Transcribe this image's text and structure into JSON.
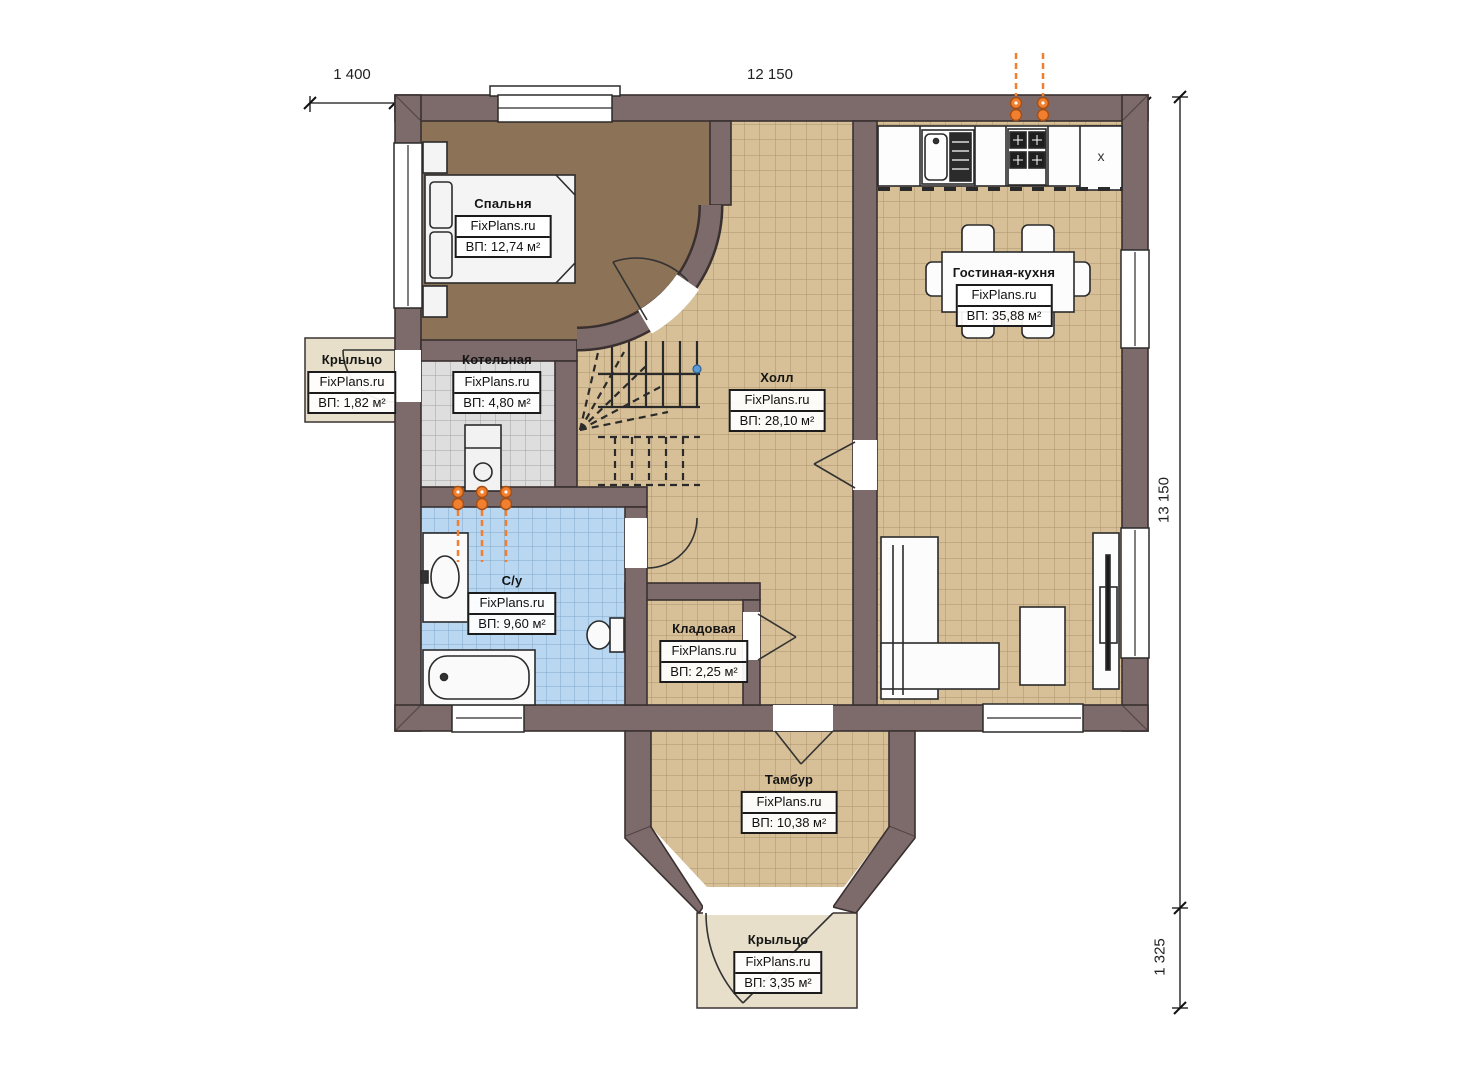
{
  "plan": {
    "watermark": "FixPlans.ru",
    "dimensions": {
      "top_left": "1 400",
      "top_width": "12 150",
      "right_height": "13 150",
      "right_porch": "1 325"
    },
    "rooms": [
      {
        "name": "Спальня",
        "area": "ВП: 12,74 м²"
      },
      {
        "name": "Котельная",
        "area": "ВП: 4,80 м²"
      },
      {
        "name": "Крыльцо",
        "area": "ВП: 1,82 м²"
      },
      {
        "name": "Холл",
        "area": "ВП: 28,10 м²"
      },
      {
        "name": "Гостиная-кухня",
        "area": "ВП: 35,88 м²"
      },
      {
        "name": "С/у",
        "area": "ВП: 9,60 м²"
      },
      {
        "name": "Кладовая",
        "area": "ВП: 2,25 м²"
      },
      {
        "name": "Тамбур",
        "area": "ВП: 10,38 м²"
      },
      {
        "name": "Крыльцо",
        "area": "ВП: 3,35 м²"
      }
    ],
    "kitchen": {
      "cabinet_mark": "x"
    },
    "colors": {
      "wall": "#7d6b6b",
      "wall_outline": "#39302f",
      "tile_tan": "#d7c097",
      "tile_gray": "#dedede",
      "tile_blue": "#b9d7f1",
      "bedroom_floor": "#8c7256",
      "porch": "#e7dfca",
      "accent_orange": "#f08030"
    }
  }
}
